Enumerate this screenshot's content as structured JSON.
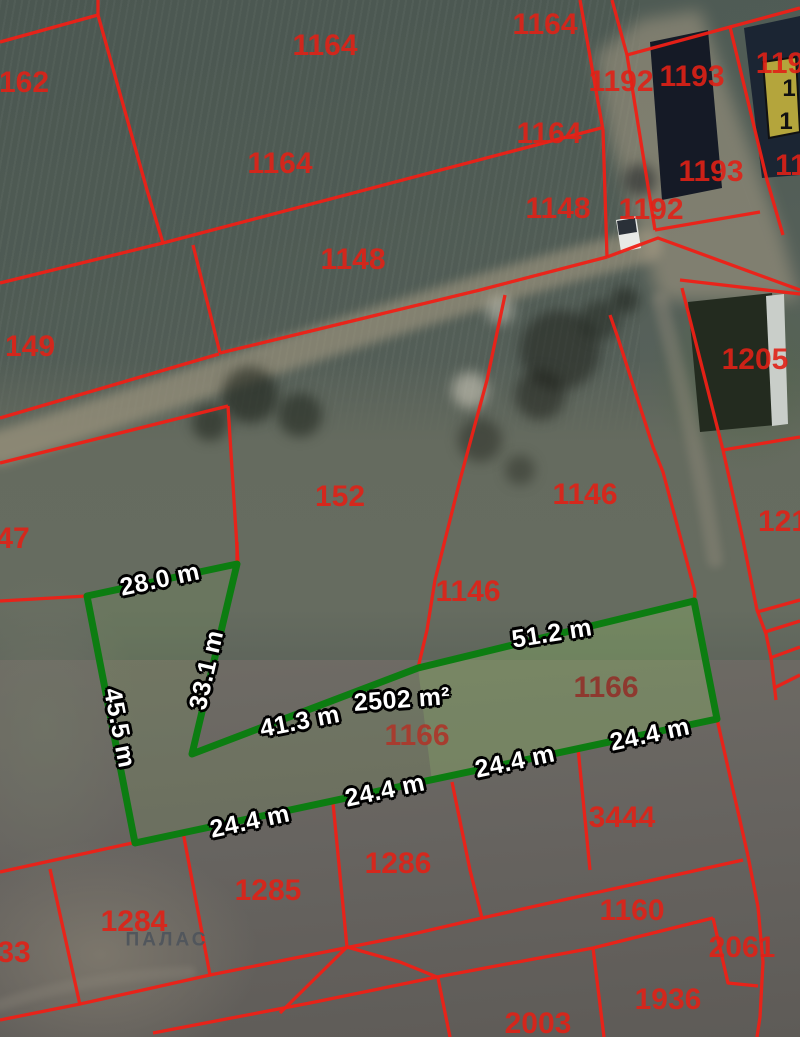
{
  "map": {
    "canvas": {
      "width": 800,
      "height": 1037
    },
    "colors": {
      "boundary_red": "#ee2016",
      "label_red": "#e02116",
      "label_red_muted": "#8f352c",
      "highlight_green": "#0c7d11",
      "highlight_fill": "rgba(130,175,95,0.16)",
      "highlight_inner_fill": "rgba(150,195,110,0.22)",
      "measure_text": "#ffffff",
      "measure_outline": "#000000",
      "place_label_gray": "#51565c",
      "building_yellow": "#b4a53c",
      "road_tan": "#ab9f86"
    },
    "highlight_parcel": {
      "area_label": "2502 m²",
      "points": [
        [
          87,
          596
        ],
        [
          237,
          564
        ],
        [
          192,
          754
        ],
        [
          418,
          668
        ],
        [
          694,
          601
        ],
        [
          717,
          719
        ],
        [
          135,
          843
        ]
      ],
      "inner_points": [
        [
          418,
          668
        ],
        [
          694,
          601
        ],
        [
          717,
          719
        ],
        [
          432,
          782
        ]
      ]
    },
    "measurements": [
      {
        "text": "28.0 m",
        "x": 160,
        "y": 580,
        "rot": -12
      },
      {
        "text": "33.1 m",
        "x": 207,
        "y": 670,
        "rot": -77
      },
      {
        "text": "45.5 m",
        "x": 119,
        "y": 728,
        "rot": 79
      },
      {
        "text": "41.3 m",
        "x": 300,
        "y": 722,
        "rot": -11
      },
      {
        "text": "2502 m²",
        "x": 402,
        "y": 700,
        "rot": -4
      },
      {
        "text": "51.2 m",
        "x": 552,
        "y": 634,
        "rot": -9
      },
      {
        "text": "24.4 m",
        "x": 250,
        "y": 822,
        "rot": -12
      },
      {
        "text": "24.4 m",
        "x": 385,
        "y": 791,
        "rot": -12
      },
      {
        "text": "24.4 m",
        "x": 515,
        "y": 762,
        "rot": -12
      },
      {
        "text": "24.4 m",
        "x": 650,
        "y": 735,
        "rot": -12
      }
    ],
    "parcel_labels": [
      {
        "text": "1164",
        "x": 545,
        "y": 25
      },
      {
        "text": "162",
        "x": 24,
        "y": 83
      },
      {
        "text": "1164",
        "x": 325,
        "y": 46
      },
      {
        "text": "1192",
        "x": 621,
        "y": 82
      },
      {
        "text": "1193",
        "x": 692,
        "y": 77
      },
      {
        "text": "119",
        "x": 780,
        "y": 64
      },
      {
        "text": "1164",
        "x": 280,
        "y": 164
      },
      {
        "text": "1164",
        "x": 549,
        "y": 134
      },
      {
        "text": "1148",
        "x": 558,
        "y": 209
      },
      {
        "text": "1192",
        "x": 651,
        "y": 210
      },
      {
        "text": "1193",
        "x": 711,
        "y": 172
      },
      {
        "text": "11",
        "x": 791,
        "y": 166
      },
      {
        "text": "1148",
        "x": 353,
        "y": 260
      },
      {
        "text": "149",
        "x": 30,
        "y": 347
      },
      {
        "text": "1205",
        "x": 755,
        "y": 360
      },
      {
        "text": "47",
        "x": 13,
        "y": 539
      },
      {
        "text": "152",
        "x": 340,
        "y": 497
      },
      {
        "text": "1146",
        "x": 585,
        "y": 495
      },
      {
        "text": "1146",
        "x": 468,
        "y": 592
      },
      {
        "text": "121",
        "x": 783,
        "y": 522
      },
      {
        "text": "1166",
        "x": 606,
        "y": 688,
        "variant": "muted"
      },
      {
        "text": "1166",
        "x": 417,
        "y": 736,
        "variant": "muted2"
      },
      {
        "text": "3444",
        "x": 622,
        "y": 818
      },
      {
        "text": "1286",
        "x": 398,
        "y": 864
      },
      {
        "text": "1285",
        "x": 268,
        "y": 891
      },
      {
        "text": "1284",
        "x": 134,
        "y": 922
      },
      {
        "text": "ПАЛАС",
        "x": 167,
        "y": 940,
        "variant": "place"
      },
      {
        "text": "33",
        "x": 14,
        "y": 953
      },
      {
        "text": "1160",
        "x": 632,
        "y": 911
      },
      {
        "text": "2061",
        "x": 742,
        "y": 948
      },
      {
        "text": "1936",
        "x": 668,
        "y": 1000
      },
      {
        "text": "2003",
        "x": 538,
        "y": 1024
      },
      {
        "text": "1",
        "x": 789,
        "y": 89,
        "variant": "building"
      },
      {
        "text": "1",
        "x": 786,
        "y": 122,
        "variant": "building"
      }
    ],
    "red_lines": [
      [
        [
          0,
          283
        ],
        [
          163,
          243
        ],
        [
          517,
          150
        ],
        [
          601,
          128
        ]
      ],
      [
        [
          98,
          0
        ],
        [
          98,
          15
        ]
      ],
      [
        [
          0,
          42
        ],
        [
          98,
          15
        ]
      ],
      [
        [
          98,
          15
        ],
        [
          147,
          190
        ],
        [
          163,
          243
        ]
      ],
      [
        [
          580,
          0
        ],
        [
          603,
          130
        ],
        [
          607,
          257
        ]
      ],
      [
        [
          612,
          0
        ],
        [
          627,
          55
        ]
      ],
      [
        [
          627,
          55
        ],
        [
          730,
          27
        ],
        [
          800,
          8
        ]
      ],
      [
        [
          730,
          27
        ],
        [
          767,
          180
        ],
        [
          783,
          235
        ]
      ],
      [
        [
          627,
          55
        ],
        [
          655,
          230
        ]
      ],
      [
        [
          655,
          230
        ],
        [
          760,
          212
        ]
      ],
      [
        [
          607,
          257
        ],
        [
          658,
          238
        ],
        [
          800,
          290
        ]
      ],
      [
        [
          680,
          280
        ],
        [
          800,
          294
        ]
      ],
      [
        [
          220,
          353
        ],
        [
          480,
          290
        ],
        [
          607,
          257
        ]
      ],
      [
        [
          193,
          245
        ],
        [
          220,
          353
        ]
      ],
      [
        [
          0,
          418
        ],
        [
          219,
          354
        ]
      ],
      [
        [
          0,
          463
        ],
        [
          228,
          406
        ]
      ],
      [
        [
          228,
          406
        ],
        [
          238,
          563
        ]
      ],
      [
        [
          0,
          601
        ],
        [
          87,
          596
        ]
      ],
      [
        [
          237,
          542
        ],
        [
          237,
          566
        ]
      ],
      [
        [
          682,
          288
        ],
        [
          723,
          450
        ]
      ],
      [
        [
          723,
          450
        ],
        [
          800,
          437
        ]
      ],
      [
        [
          505,
          295
        ],
        [
          487,
          380
        ],
        [
          460,
          480
        ],
        [
          435,
          580
        ],
        [
          427,
          630
        ],
        [
          418,
          668
        ]
      ],
      [
        [
          610,
          315
        ],
        [
          618,
          338
        ],
        [
          653,
          447
        ],
        [
          663,
          472
        ],
        [
          695,
          592
        ],
        [
          694,
          604
        ]
      ],
      [
        [
          717,
          719
        ],
        [
          748,
          856
        ]
      ],
      [
        [
          723,
          450
        ],
        [
          743,
          540
        ],
        [
          757,
          610
        ],
        [
          766,
          634
        ],
        [
          771,
          658
        ],
        [
          776,
          700
        ]
      ],
      [
        [
          757,
          612
        ],
        [
          800,
          600
        ]
      ],
      [
        [
          765,
          632
        ],
        [
          800,
          621
        ]
      ],
      [
        [
          770,
          658
        ],
        [
          800,
          647
        ]
      ],
      [
        [
          774,
          688
        ],
        [
          800,
          675
        ]
      ],
      [
        [
          748,
          856
        ],
        [
          758,
          907
        ],
        [
          763,
          962
        ],
        [
          760,
          1017
        ],
        [
          757,
          1037
        ]
      ],
      [
        [
          0,
          872
        ],
        [
          137,
          842
        ]
      ],
      [
        [
          183,
          832
        ],
        [
          210,
          975
        ]
      ],
      [
        [
          333,
          803
        ],
        [
          347,
          947
        ]
      ],
      [
        [
          452,
          782
        ],
        [
          470,
          870
        ],
        [
          482,
          918
        ]
      ],
      [
        [
          578,
          748
        ],
        [
          590,
          870
        ]
      ],
      [
        [
          0,
          1020
        ],
        [
          80,
          1004
        ],
        [
          210,
          975
        ],
        [
          400,
          937
        ],
        [
          482,
          918
        ],
        [
          743,
          860
        ]
      ],
      [
        [
          153,
          1033
        ],
        [
          310,
          1003
        ],
        [
          437,
          977
        ],
        [
          593,
          948
        ],
        [
          713,
          918
        ]
      ],
      [
        [
          438,
          978
        ],
        [
          450,
          1037
        ]
      ],
      [
        [
          593,
          948
        ],
        [
          604,
          1037
        ]
      ],
      [
        [
          713,
          918
        ],
        [
          728,
          983
        ],
        [
          758,
          986
        ]
      ],
      [
        [
          50,
          869
        ],
        [
          80,
          1005
        ]
      ],
      [
        [
          347,
          947
        ],
        [
          400,
          962
        ],
        [
          437,
          977
        ]
      ],
      [
        [
          280,
          1013
        ],
        [
          347,
          947
        ]
      ]
    ],
    "buildings": [
      {
        "name": "dark-roof-building-1193",
        "points": [
          [
            650,
            42
          ],
          [
            708,
            30
          ],
          [
            722,
            188
          ],
          [
            662,
            200
          ]
        ],
        "fill": "#151a26"
      },
      {
        "name": "dark-roof-building-ne",
        "points": [
          [
            744,
            28
          ],
          [
            800,
            16
          ],
          [
            800,
            175
          ],
          [
            762,
            178
          ]
        ],
        "fill": "#1b2533"
      },
      {
        "name": "yellow-building",
        "points": [
          [
            763,
            62
          ],
          [
            796,
            57
          ],
          [
            800,
            132
          ],
          [
            769,
            138
          ]
        ],
        "fill": "#b4a53c",
        "stroke": "#111111"
      },
      {
        "name": "building-1205",
        "points": [
          [
            688,
            302
          ],
          [
            772,
            293
          ],
          [
            786,
            424
          ],
          [
            700,
            432
          ]
        ],
        "fill": "#232b1f"
      },
      {
        "name": "building-1205-white-edge",
        "points": [
          [
            766,
            296
          ],
          [
            784,
            294
          ],
          [
            788,
            424
          ],
          [
            772,
            426
          ]
        ],
        "fill": "#c9cec9"
      },
      {
        "name": "white-vehicle",
        "points": [
          [
            616,
            220
          ],
          [
            636,
            216
          ],
          [
            641,
            248
          ],
          [
            621,
            252
          ]
        ],
        "fill": "#e8e9e6"
      },
      {
        "name": "vehicle-windshield",
        "points": [
          [
            617,
            221
          ],
          [
            635,
            218
          ],
          [
            637,
            232
          ],
          [
            619,
            235
          ]
        ],
        "fill": "#2a3038"
      }
    ],
    "roads": [
      {
        "name": "dirt-road",
        "d": "M0,448 C150,400 350,330 520,280 C580,262 610,255 645,246",
        "stroke": "#ab9f86",
        "width": 34,
        "opacity": 0.55,
        "blur": 5
      },
      {
        "name": "gravel-yard",
        "d": "M595,55 L640,20 L700,10 L780,230 L800,300 L660,300 L610,140 Z",
        "fill": "#ac9f88",
        "opacity": 0.5,
        "blur": 8
      },
      {
        "name": "driveway",
        "d": "M660,300 C680,380 700,460 715,560",
        "stroke": "#9a9181",
        "width": 16,
        "opacity": 0.35,
        "blur": 4
      },
      {
        "name": "track-bottom-left",
        "d": "M0,1005 C60,985 120,975 190,972",
        "stroke": "#8e887c",
        "width": 12,
        "opacity": 0.3,
        "blur": 3
      }
    ],
    "blobs": [
      {
        "x": 560,
        "y": 350,
        "r": 40,
        "c": "rgba(25,28,22,0.5)"
      },
      {
        "x": 540,
        "y": 395,
        "r": 25,
        "c": "rgba(25,28,22,0.5)"
      },
      {
        "x": 600,
        "y": 320,
        "r": 20,
        "c": "rgba(25,28,22,0.45)"
      },
      {
        "x": 480,
        "y": 440,
        "r": 22,
        "c": "rgba(30,33,26,0.45)"
      },
      {
        "x": 520,
        "y": 470,
        "r": 15,
        "c": "rgba(30,33,26,0.4)"
      },
      {
        "x": 250,
        "y": 395,
        "r": 28,
        "c": "rgba(22,28,20,0.55)"
      },
      {
        "x": 300,
        "y": 415,
        "r": 22,
        "c": "rgba(22,28,20,0.5)"
      },
      {
        "x": 210,
        "y": 423,
        "r": 18,
        "c": "rgba(22,28,20,0.5)"
      },
      {
        "x": 470,
        "y": 390,
        "r": 18,
        "c": "rgba(225,219,203,0.5)"
      },
      {
        "x": 500,
        "y": 310,
        "r": 14,
        "c": "rgba(225,219,203,0.45)"
      },
      {
        "x": 640,
        "y": 180,
        "r": 16,
        "c": "rgba(20,24,30,0.5)"
      },
      {
        "x": 625,
        "y": 300,
        "r": 14,
        "c": "rgba(20,24,18,0.5)"
      }
    ]
  }
}
